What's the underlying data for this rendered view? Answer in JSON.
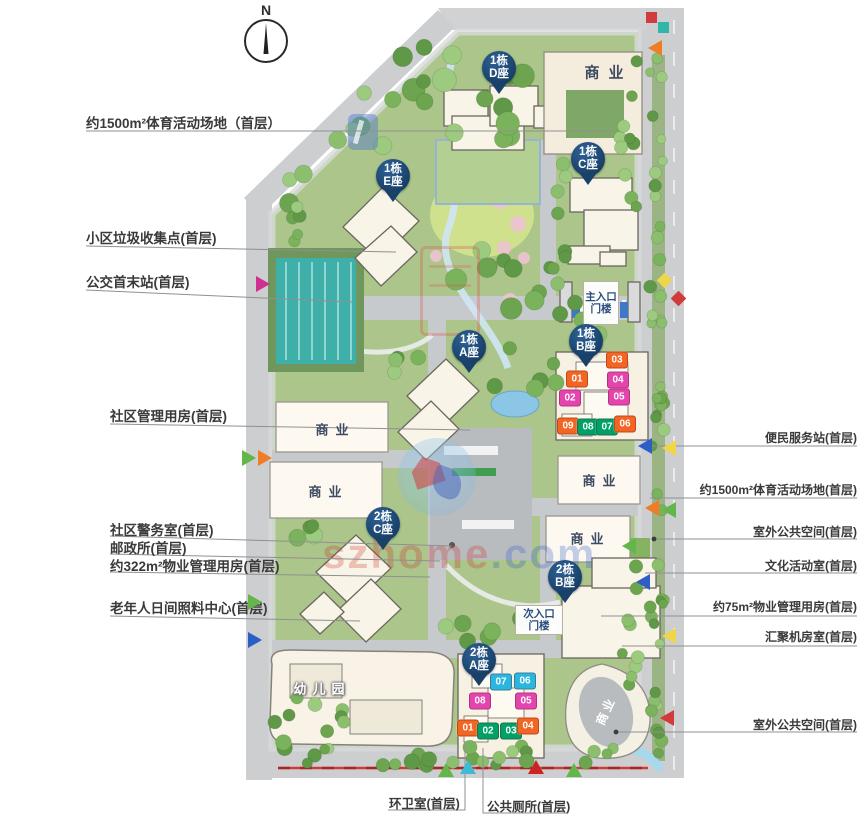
{
  "compass": {
    "label": "N"
  },
  "watermark": {
    "site_name_red": "szhome",
    "site_name_blue": ".com"
  },
  "callouts": {
    "left": [
      {
        "label": "约1500m²体育活动场地（首层）",
        "tx": 86,
        "ty": 112,
        "line": "86,131 612,131"
      },
      {
        "label": "小区垃圾收集点(首层)",
        "tx": 86,
        "ty": 227,
        "line": "86,246 396,252"
      },
      {
        "label": "公交首末站(首层)",
        "tx": 86,
        "ty": 271,
        "line": "86,290 352,302"
      },
      {
        "label": "社区管理用房(首层)",
        "tx": 110,
        "ty": 405,
        "line": "110,424 470,430"
      },
      {
        "label": "社区警务室(首层)",
        "tx": 110,
        "ty": 519,
        "line": "110,536 452,546"
      },
      {
        "label": "邮政所(首层)",
        "tx": 110,
        "ty": 537,
        "line": "110,554 440,561"
      },
      {
        "label": "约322m²物业管理用房(首层)",
        "tx": 110,
        "ty": 555,
        "line": "110,572 430,577"
      },
      {
        "label": "老年人日间照料中心(首层)",
        "tx": 110,
        "ty": 597,
        "line": "110,616 360,621"
      }
    ],
    "right": [
      {
        "label": "便民服务站(首层)",
        "tx": 857,
        "ty": 429,
        "line": "641,446 857,446"
      },
      {
        "label": "约1500m²体育活动场地(首层)",
        "tx": 857,
        "ty": 481,
        "line": "650,498 857,498"
      },
      {
        "label": "室外公共空间(首层)",
        "tx": 857,
        "ty": 523,
        "line": "654,539 857,539",
        "dot": true
      },
      {
        "label": "文化活动室(首层)",
        "tx": 857,
        "ty": 557,
        "line": "645,573 857,573"
      },
      {
        "label": "约75m²物业管理用房(首层)",
        "tx": 857,
        "ty": 598,
        "line": "601,616 857,616"
      },
      {
        "label": "汇聚机房室(首层)",
        "tx": 857,
        "ty": 628,
        "line": "622,646 857,646"
      },
      {
        "label": "室外公共空间(首层)",
        "tx": 857,
        "ty": 716,
        "line": "616,732 857,732",
        "dot": true
      }
    ],
    "bottom": [
      {
        "label": "环卫室(首层)",
        "tx": 389,
        "ty": 793,
        "line": "465,743 465,810 388,810"
      },
      {
        "label": "公共厕所(首层)",
        "tx": 487,
        "ty": 796,
        "line": "483,748 483,813 567,813"
      }
    ]
  },
  "pins": [
    {
      "top": "1栋",
      "bottom": "D座",
      "x": 499,
      "y": 68
    },
    {
      "top": "1栋",
      "bottom": "E座",
      "x": 393,
      "y": 176
    },
    {
      "top": "1栋",
      "bottom": "C座",
      "x": 588,
      "y": 159
    },
    {
      "top": "1栋",
      "bottom": "A座",
      "x": 469,
      "y": 347
    },
    {
      "top": "1栋",
      "bottom": "B座",
      "x": 586,
      "y": 341
    },
    {
      "top": "2栋",
      "bottom": "C座",
      "x": 383,
      "y": 524
    },
    {
      "top": "2栋",
      "bottom": "B座",
      "x": 565,
      "y": 577
    },
    {
      "top": "2栋",
      "bottom": "A座",
      "x": 479,
      "y": 660
    }
  ],
  "gates": [
    {
      "line1": "主入口",
      "line2": "门楼",
      "x": 583,
      "y": 281,
      "w": 34,
      "h": 42
    },
    {
      "line1": "次入口",
      "line2": "门楼",
      "x": 515,
      "y": 605,
      "w": 46,
      "h": 28
    }
  ],
  "area_labels": [
    {
      "text": "商业",
      "x": 604,
      "y": 72,
      "variant": "navy",
      "size": 15,
      "ls": 9
    },
    {
      "text": "商业",
      "x": 332,
      "y": 429,
      "variant": "navy",
      "size": 13,
      "ls": 7
    },
    {
      "text": "商业",
      "x": 325,
      "y": 491,
      "variant": "navy",
      "size": 13,
      "ls": 7
    },
    {
      "text": "商业",
      "x": 599,
      "y": 480,
      "variant": "navy",
      "size": 13,
      "ls": 7
    },
    {
      "text": "商业",
      "x": 587,
      "y": 538,
      "variant": "navy",
      "size": 13,
      "ls": 7
    },
    {
      "text": "商业",
      "x": 605,
      "y": 712,
      "variant": "rotated",
      "size": 12,
      "ls": 3
    },
    {
      "text": "幼儿园",
      "x": 319,
      "y": 688,
      "variant": "outline",
      "size": 13,
      "ls": 6
    }
  ],
  "badge_colors": {
    "orange": "#f26522",
    "magenta": "#e444ae",
    "green": "#00a066",
    "cyan": "#2ab6df"
  },
  "unit_badges": [
    {
      "no": "03",
      "color": "orange",
      "x": 617,
      "y": 360
    },
    {
      "no": "01",
      "color": "orange",
      "x": 577,
      "y": 379
    },
    {
      "no": "04",
      "color": "magenta",
      "x": 618,
      "y": 380
    },
    {
      "no": "02",
      "color": "magenta",
      "x": 570,
      "y": 398
    },
    {
      "no": "05",
      "color": "magenta",
      "x": 619,
      "y": 397
    },
    {
      "no": "09",
      "color": "orange",
      "x": 568,
      "y": 426
    },
    {
      "no": "08",
      "color": "green",
      "x": 588,
      "y": 427
    },
    {
      "no": "07",
      "color": "green",
      "x": 607,
      "y": 427
    },
    {
      "no": "06",
      "color": "orange",
      "x": 625,
      "y": 424
    },
    {
      "no": "07",
      "color": "cyan",
      "x": 501,
      "y": 682
    },
    {
      "no": "06",
      "color": "cyan",
      "x": 525,
      "y": 681
    },
    {
      "no": "08",
      "color": "magenta",
      "x": 480,
      "y": 701
    },
    {
      "no": "05",
      "color": "magenta",
      "x": 526,
      "y": 701
    },
    {
      "no": "01",
      "color": "orange",
      "x": 468,
      "y": 728
    },
    {
      "no": "02",
      "color": "green",
      "x": 488,
      "y": 731
    },
    {
      "no": "03",
      "color": "green",
      "x": 511,
      "y": 731
    },
    {
      "no": "04",
      "color": "orange",
      "x": 528,
      "y": 726
    }
  ],
  "markers": [
    {
      "x": 256,
      "y": 276,
      "dir": "right",
      "color": "#cf2f8f"
    },
    {
      "x": 242,
      "y": 450,
      "dir": "right",
      "color": "#62b64a"
    },
    {
      "x": 258,
      "y": 450,
      "dir": "right",
      "color": "#ef7d28"
    },
    {
      "x": 248,
      "y": 594,
      "dir": "right",
      "color": "#62b64a"
    },
    {
      "x": 248,
      "y": 632,
      "dir": "right",
      "color": "#2d5ec6"
    },
    {
      "x": 648,
      "y": 40,
      "dir": "left",
      "color": "#ef7d28"
    },
    {
      "x": 638,
      "y": 438,
      "dir": "left",
      "color": "#2d5ec6"
    },
    {
      "x": 662,
      "y": 440,
      "dir": "left",
      "color": "#efd54a"
    },
    {
      "x": 645,
      "y": 500,
      "dir": "left",
      "color": "#ef7d28"
    },
    {
      "x": 662,
      "y": 502,
      "dir": "left",
      "color": "#62b64a"
    },
    {
      "x": 622,
      "y": 538,
      "dir": "left",
      "color": "#62b64a"
    },
    {
      "x": 636,
      "y": 574,
      "dir": "left",
      "color": "#2d5ec6"
    },
    {
      "x": 662,
      "y": 628,
      "dir": "left",
      "color": "#efd54a"
    },
    {
      "x": 660,
      "y": 710,
      "dir": "left",
      "color": "#d23b3b"
    },
    {
      "x": 460,
      "y": 760,
      "dir": "up",
      "color": "#3bbcd4"
    },
    {
      "x": 438,
      "y": 763,
      "dir": "up",
      "color": "#62b64a"
    },
    {
      "x": 528,
      "y": 760,
      "dir": "up",
      "color": "#cc2424"
    },
    {
      "x": 566,
      "y": 763,
      "dir": "up",
      "color": "#62b64a"
    },
    {
      "x": 659,
      "y": 275,
      "dir": "diamond",
      "color": "#efd54a"
    },
    {
      "x": 673,
      "y": 293,
      "dir": "diamond",
      "color": "#d23b3b"
    },
    {
      "x": 646,
      "y": 12,
      "dir": "square",
      "color": "#d23b3b"
    },
    {
      "x": 658,
      "y": 22,
      "dir": "square",
      "color": "#2fb6a8"
    }
  ]
}
